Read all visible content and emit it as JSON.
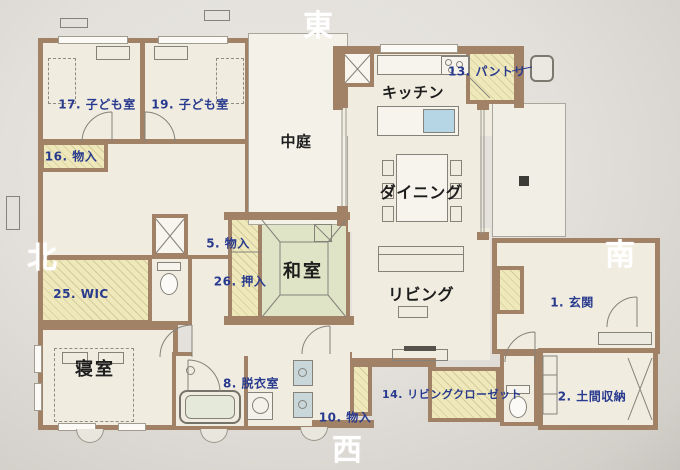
{
  "compass": {
    "east": "東",
    "west": "西",
    "north": "北",
    "south": "南"
  },
  "rooms": {
    "child_room_17": "17. 子ども室",
    "child_room_19": "19. 子ども室",
    "storage_16": "16. 物入",
    "courtyard": "中庭",
    "kitchen": "キッチン",
    "pantry_13": "13. パントリ",
    "dining": "ダイニング",
    "storage_5": "5. 物入",
    "japanese_room": "和室",
    "wic_25": "25. WIC",
    "oshiire_26": "26. 押入",
    "living": "リビング",
    "entrance_1": "1. 玄関",
    "bedroom": "寝室",
    "dressing_room_8": "8. 脱衣室",
    "storage_10": "10. 物入",
    "living_closet_14": "14. リビングクローゼット",
    "doma_storage_2": "2. 土間収納"
  },
  "colors": {
    "wall": "#a28267",
    "floor_cream": "#f0ece0",
    "closet_yellow": "#efe8bb",
    "tatami_green": "#e0e4c6",
    "courtyard": "#f4f1e9",
    "label_blue": "#283a8e",
    "label_black": "#1d1d1d",
    "direction_white": "#ffffff",
    "sink_blue": "#b7d6e5",
    "paper": "#e3e0db"
  }
}
